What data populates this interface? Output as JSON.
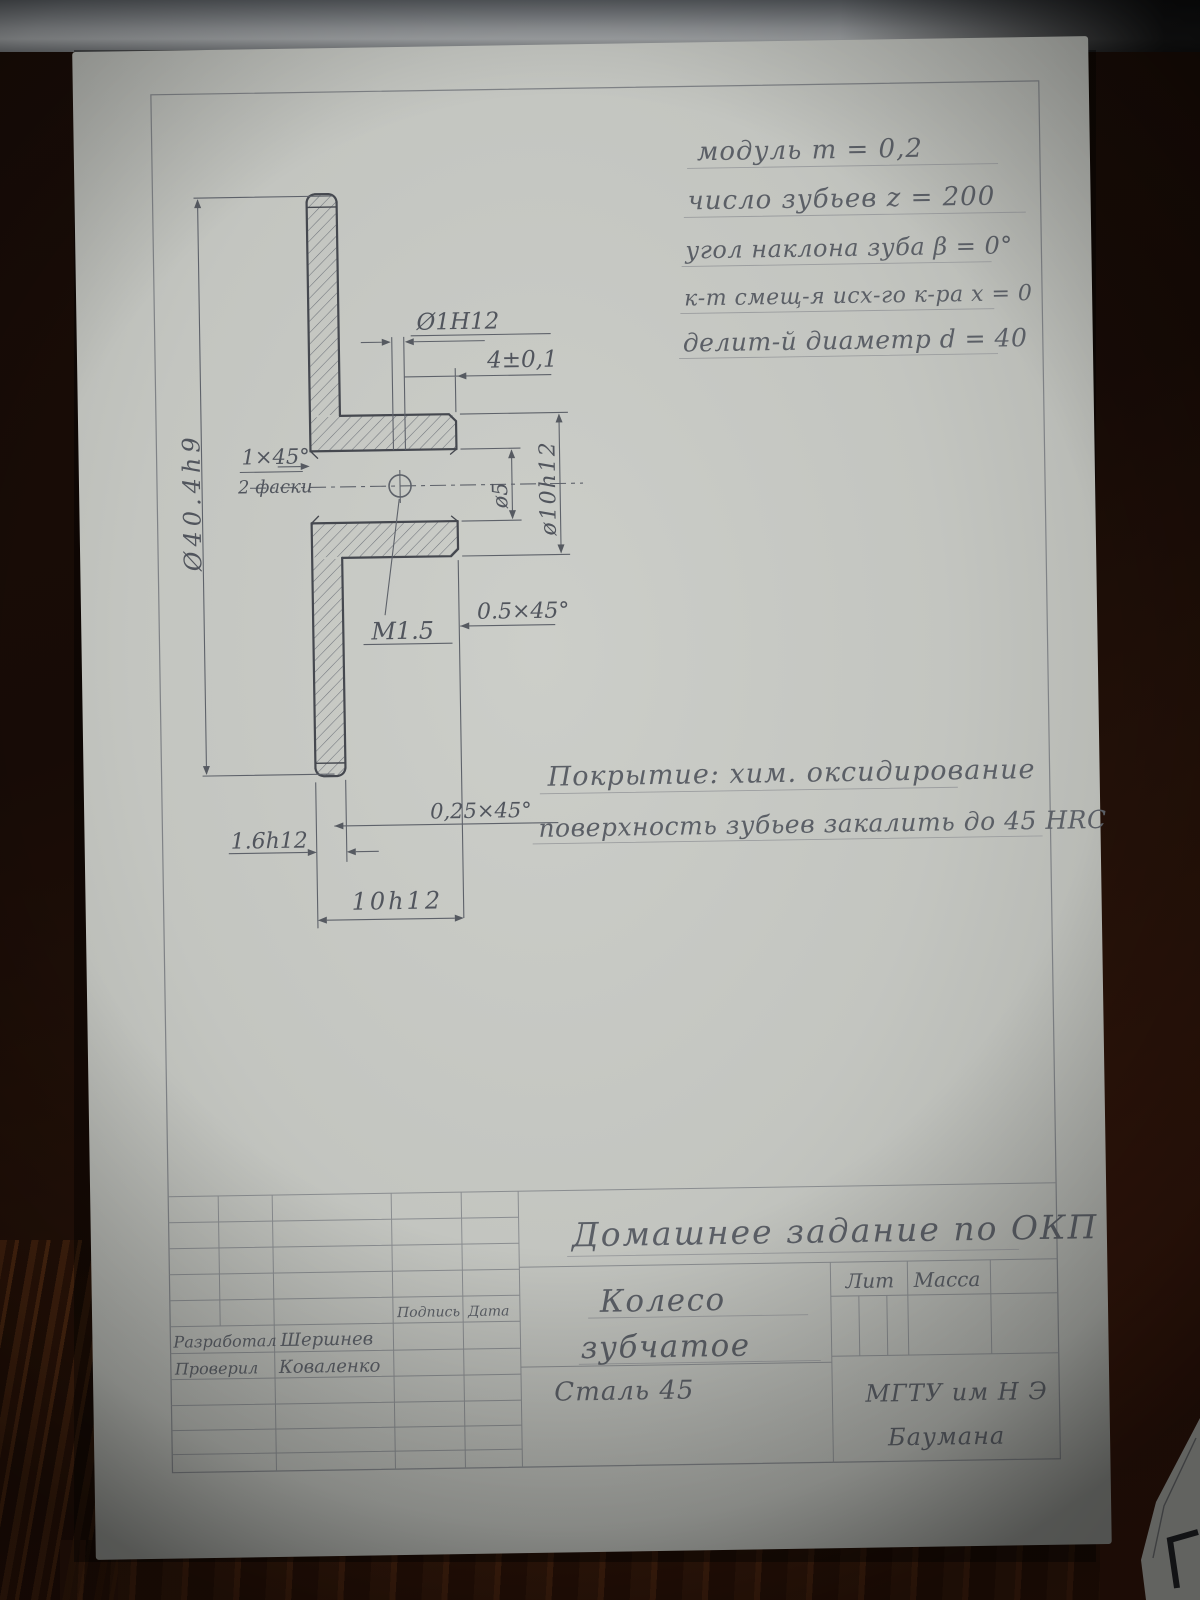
{
  "photo_subject": "hand-drawn gear wheel engineering drawing on wooden desk",
  "colors": {
    "paper": "#c6c8c3",
    "pencil_dark": "#45484f",
    "pencil_light": "#8a8d90",
    "wood": "#31150a",
    "desk_edge_gray": "#8f9295"
  },
  "notes": {
    "module": "модуль   m = 0,2",
    "teeth": "число зубьев  z = 200",
    "angle": "угол наклона зуба  β = 0°",
    "shift": "к-т смещ-я исх-го к-ра  x = 0",
    "pitch": "делит-й диаметр d = 40"
  },
  "coating": {
    "line1": "Покрытие: хим. оксидирование",
    "line2": "поверхность зубьев закалить до 45 HRC"
  },
  "dims": {
    "outer_dia": "Ø40.4h9",
    "hole": "Ø1H12",
    "hole_pos": "4±0,1",
    "chamfer1a": "1×45°",
    "chamfer1b": "2 фаски",
    "bore": "ø5",
    "hub_dia": "ø10h12",
    "thread": "М1.5",
    "chamfer05": "0.5×45°",
    "chamfer025": "0,25×45°",
    "disc_thickness": "1.6h12",
    "hub_width": "10h12"
  },
  "title_block": {
    "assignment": "Домашнее задание по ОКП",
    "part_name_line1": "Колесо",
    "part_name_line2": "зубчатое",
    "material": "Сталь 45",
    "lit": "Лит",
    "mass": "Масса",
    "sign": "Подпись",
    "date": "Дата",
    "developed_label": "Разработал",
    "developed_name": "Шершнев",
    "checked_label": "Проверил",
    "checked_name": "Коваленко",
    "org_line1": "МГТУ им Н Э",
    "org_line2": "Баумана"
  }
}
